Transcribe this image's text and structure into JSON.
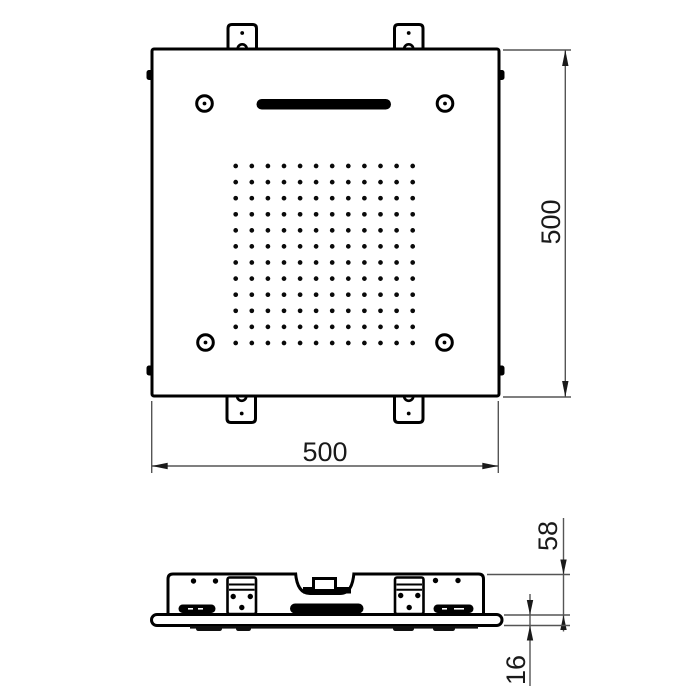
{
  "drawing": {
    "type": "technical-dimension-drawing",
    "colors": {
      "line": "#000000",
      "dimension_line": "#555555",
      "arrow": "#1a1a1a",
      "background": "#ffffff"
    },
    "top_view": {
      "width_label": "500",
      "height_label": "500",
      "nozzle_grid": {
        "rows": 12,
        "cols": 12
      },
      "corner_screw_count": 4,
      "mounting_bracket_count": 4
    },
    "side_view": {
      "housing_height_label": "58",
      "plate_thickness_label": "16"
    }
  }
}
